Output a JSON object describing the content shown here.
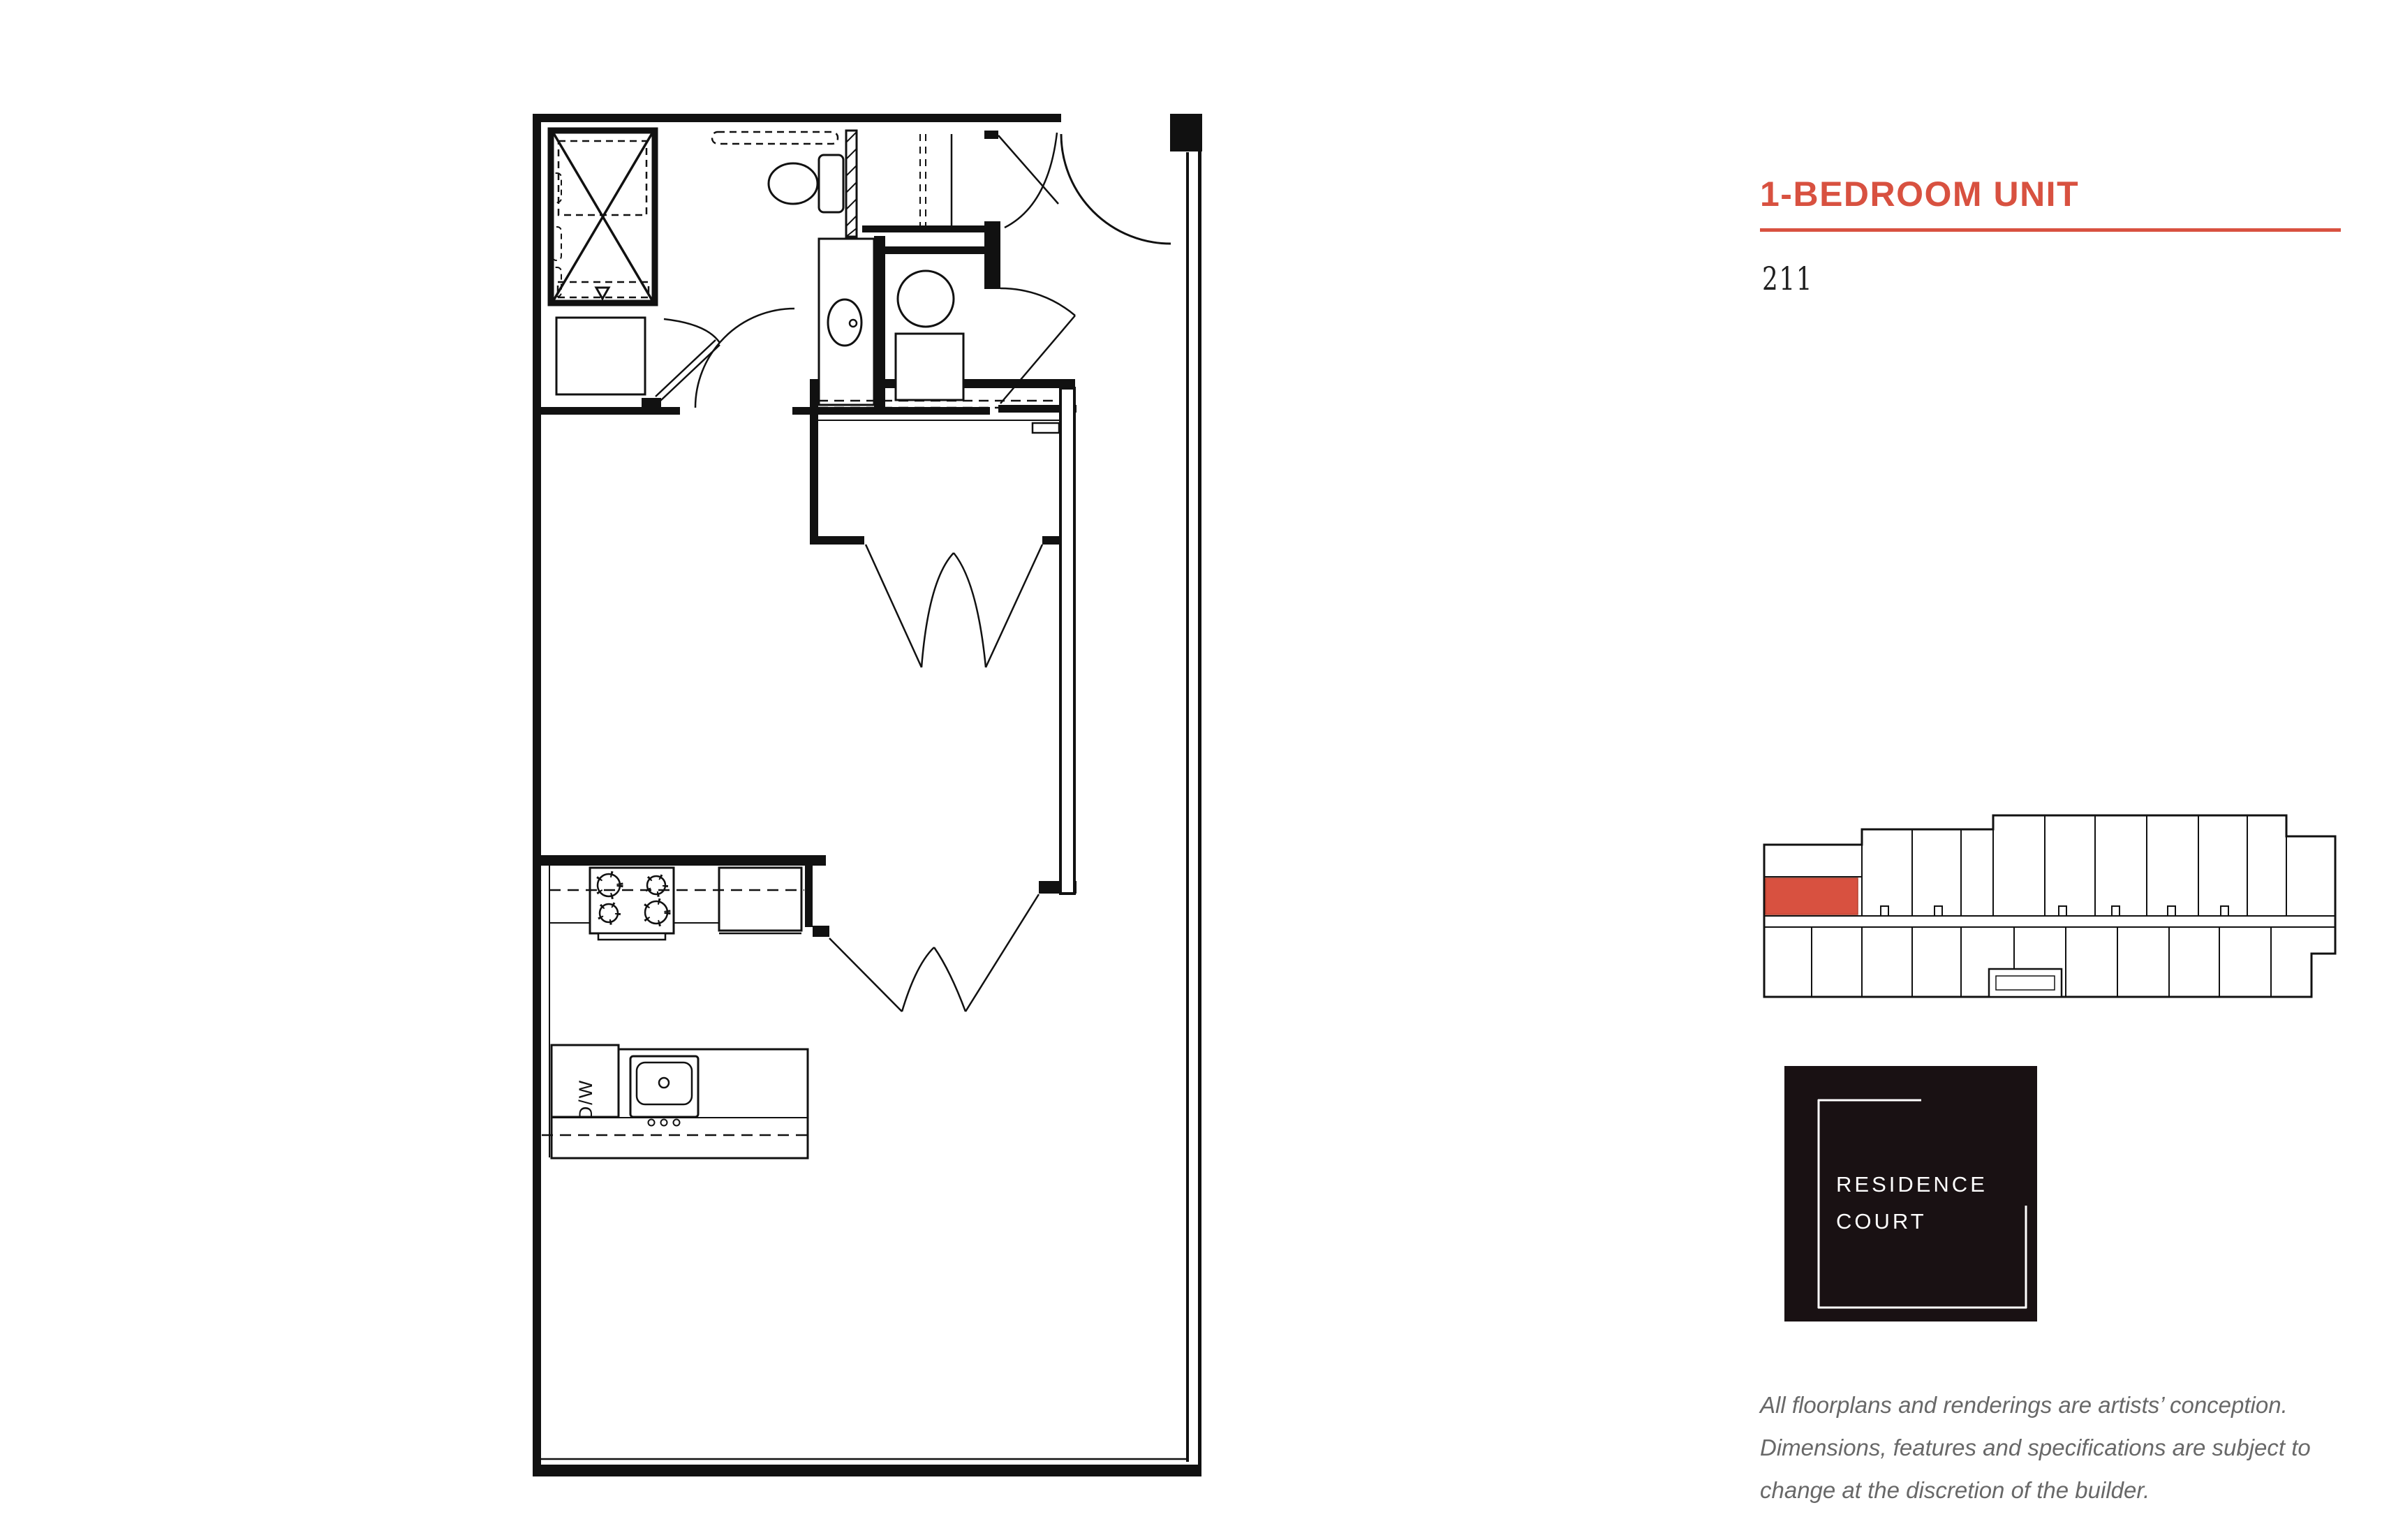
{
  "header": {
    "title": "1-BEDROOM UNIT",
    "unit_number": "211",
    "accent_color": "#d85140"
  },
  "floorplan": {
    "dw_label": "D/W",
    "line_color": "#111111",
    "rooms": [
      "bathroom",
      "washer-dryer closet",
      "coat closet",
      "bedroom",
      "bedroom closet",
      "kitchen",
      "living room",
      "entry hall"
    ],
    "fixtures": [
      "shower-tub",
      "toilet",
      "vanity-sink",
      "second-toilet",
      "stove",
      "refrigerator",
      "dishwasher",
      "kitchen-sink",
      "island"
    ]
  },
  "keyplan": {
    "highlight_color": "#d85140",
    "highlighted_unit": "211"
  },
  "logo": {
    "line1": "RESIDENCE",
    "line2": "COURT",
    "background": "#191113",
    "text_color": "#ffffff"
  },
  "disclaimer": {
    "lines": [
      "All floorplans and renderings are artists’ conception.",
      "Dimensions, features and specifications are subject to",
      "change at the discretion of the builder."
    ]
  }
}
